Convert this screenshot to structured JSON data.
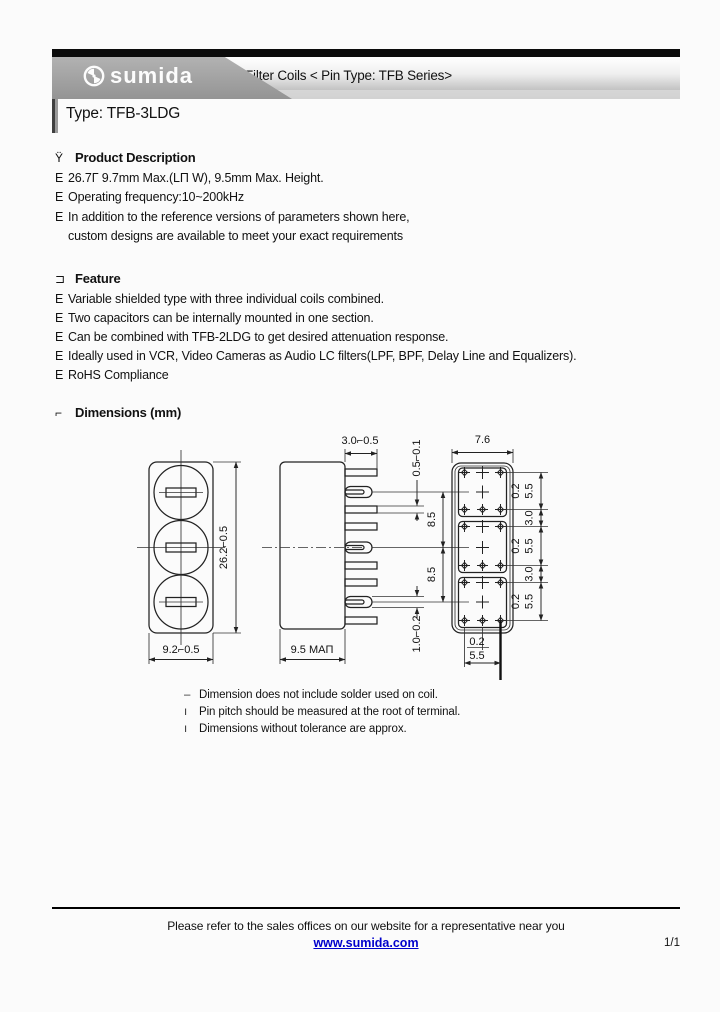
{
  "header": {
    "brand": "sumida",
    "doc_title": "Filter Coils < Pin Type: TFB Series>",
    "type_title": "Type: TFB-3LDG"
  },
  "product_description": {
    "marker": "Ÿ",
    "heading": "Product Description",
    "items": [
      {
        "bullet": "E",
        "text": "26.7Γ 9.7mm Max.(LΠ W), 9.5mm Max. Height."
      },
      {
        "bullet": "E",
        "text": "Operating frequency:10~200kHz"
      },
      {
        "bullet": "E",
        "text": "In addition to the reference versions of parameters shown here,"
      },
      {
        "bullet": "",
        "text": "custom designs are available to meet your exact requirements"
      }
    ]
  },
  "feature": {
    "marker": "⊐",
    "heading": "Feature",
    "items": [
      {
        "bullet": "E",
        "text": "Variable shielded type with three individual coils combined."
      },
      {
        "bullet": "E",
        "text": "Two capacitors can be internally mounted in one section."
      },
      {
        "bullet": "E",
        "text": "Can be combined with TFB-2LDG to get desired attenuation response."
      },
      {
        "bullet": "E",
        "text": "Ideally used in VCR, Video Cameras as Audio LC filters(LPF, BPF, Delay Line and Equalizers)."
      },
      {
        "bullet": "E",
        "text": "RoHS Compliance"
      }
    ]
  },
  "dimensions": {
    "marker": "⌐",
    "heading": "Dimensions (mm)",
    "labels": {
      "front_height": "26.2⌐0.5",
      "front_width": "9.2⌐0.5",
      "pin_length": "3.0⌐0.5",
      "pin_thickness": "0.5⌐0.1",
      "pin_root": "1.0⌐0.2",
      "side_width": "9.5 MAΠ",
      "pitch": "8.5",
      "top_width": "7.6",
      "row_offset": "0.2",
      "row_span": "5.5",
      "row_gap": "3.0"
    },
    "notes": [
      {
        "bullet": "–",
        "text": "Dimension does not include solder used on coil."
      },
      {
        "bullet": "ı",
        "text": "Pin pitch should be measured at the root of terminal."
      },
      {
        "bullet": "ı",
        "text": "Dimensions without tolerance are approx."
      }
    ]
  },
  "footer": {
    "note": "Please refer to the sales offices on our website for a representative near you",
    "link": "www.sumida.com",
    "page": "1/1"
  }
}
